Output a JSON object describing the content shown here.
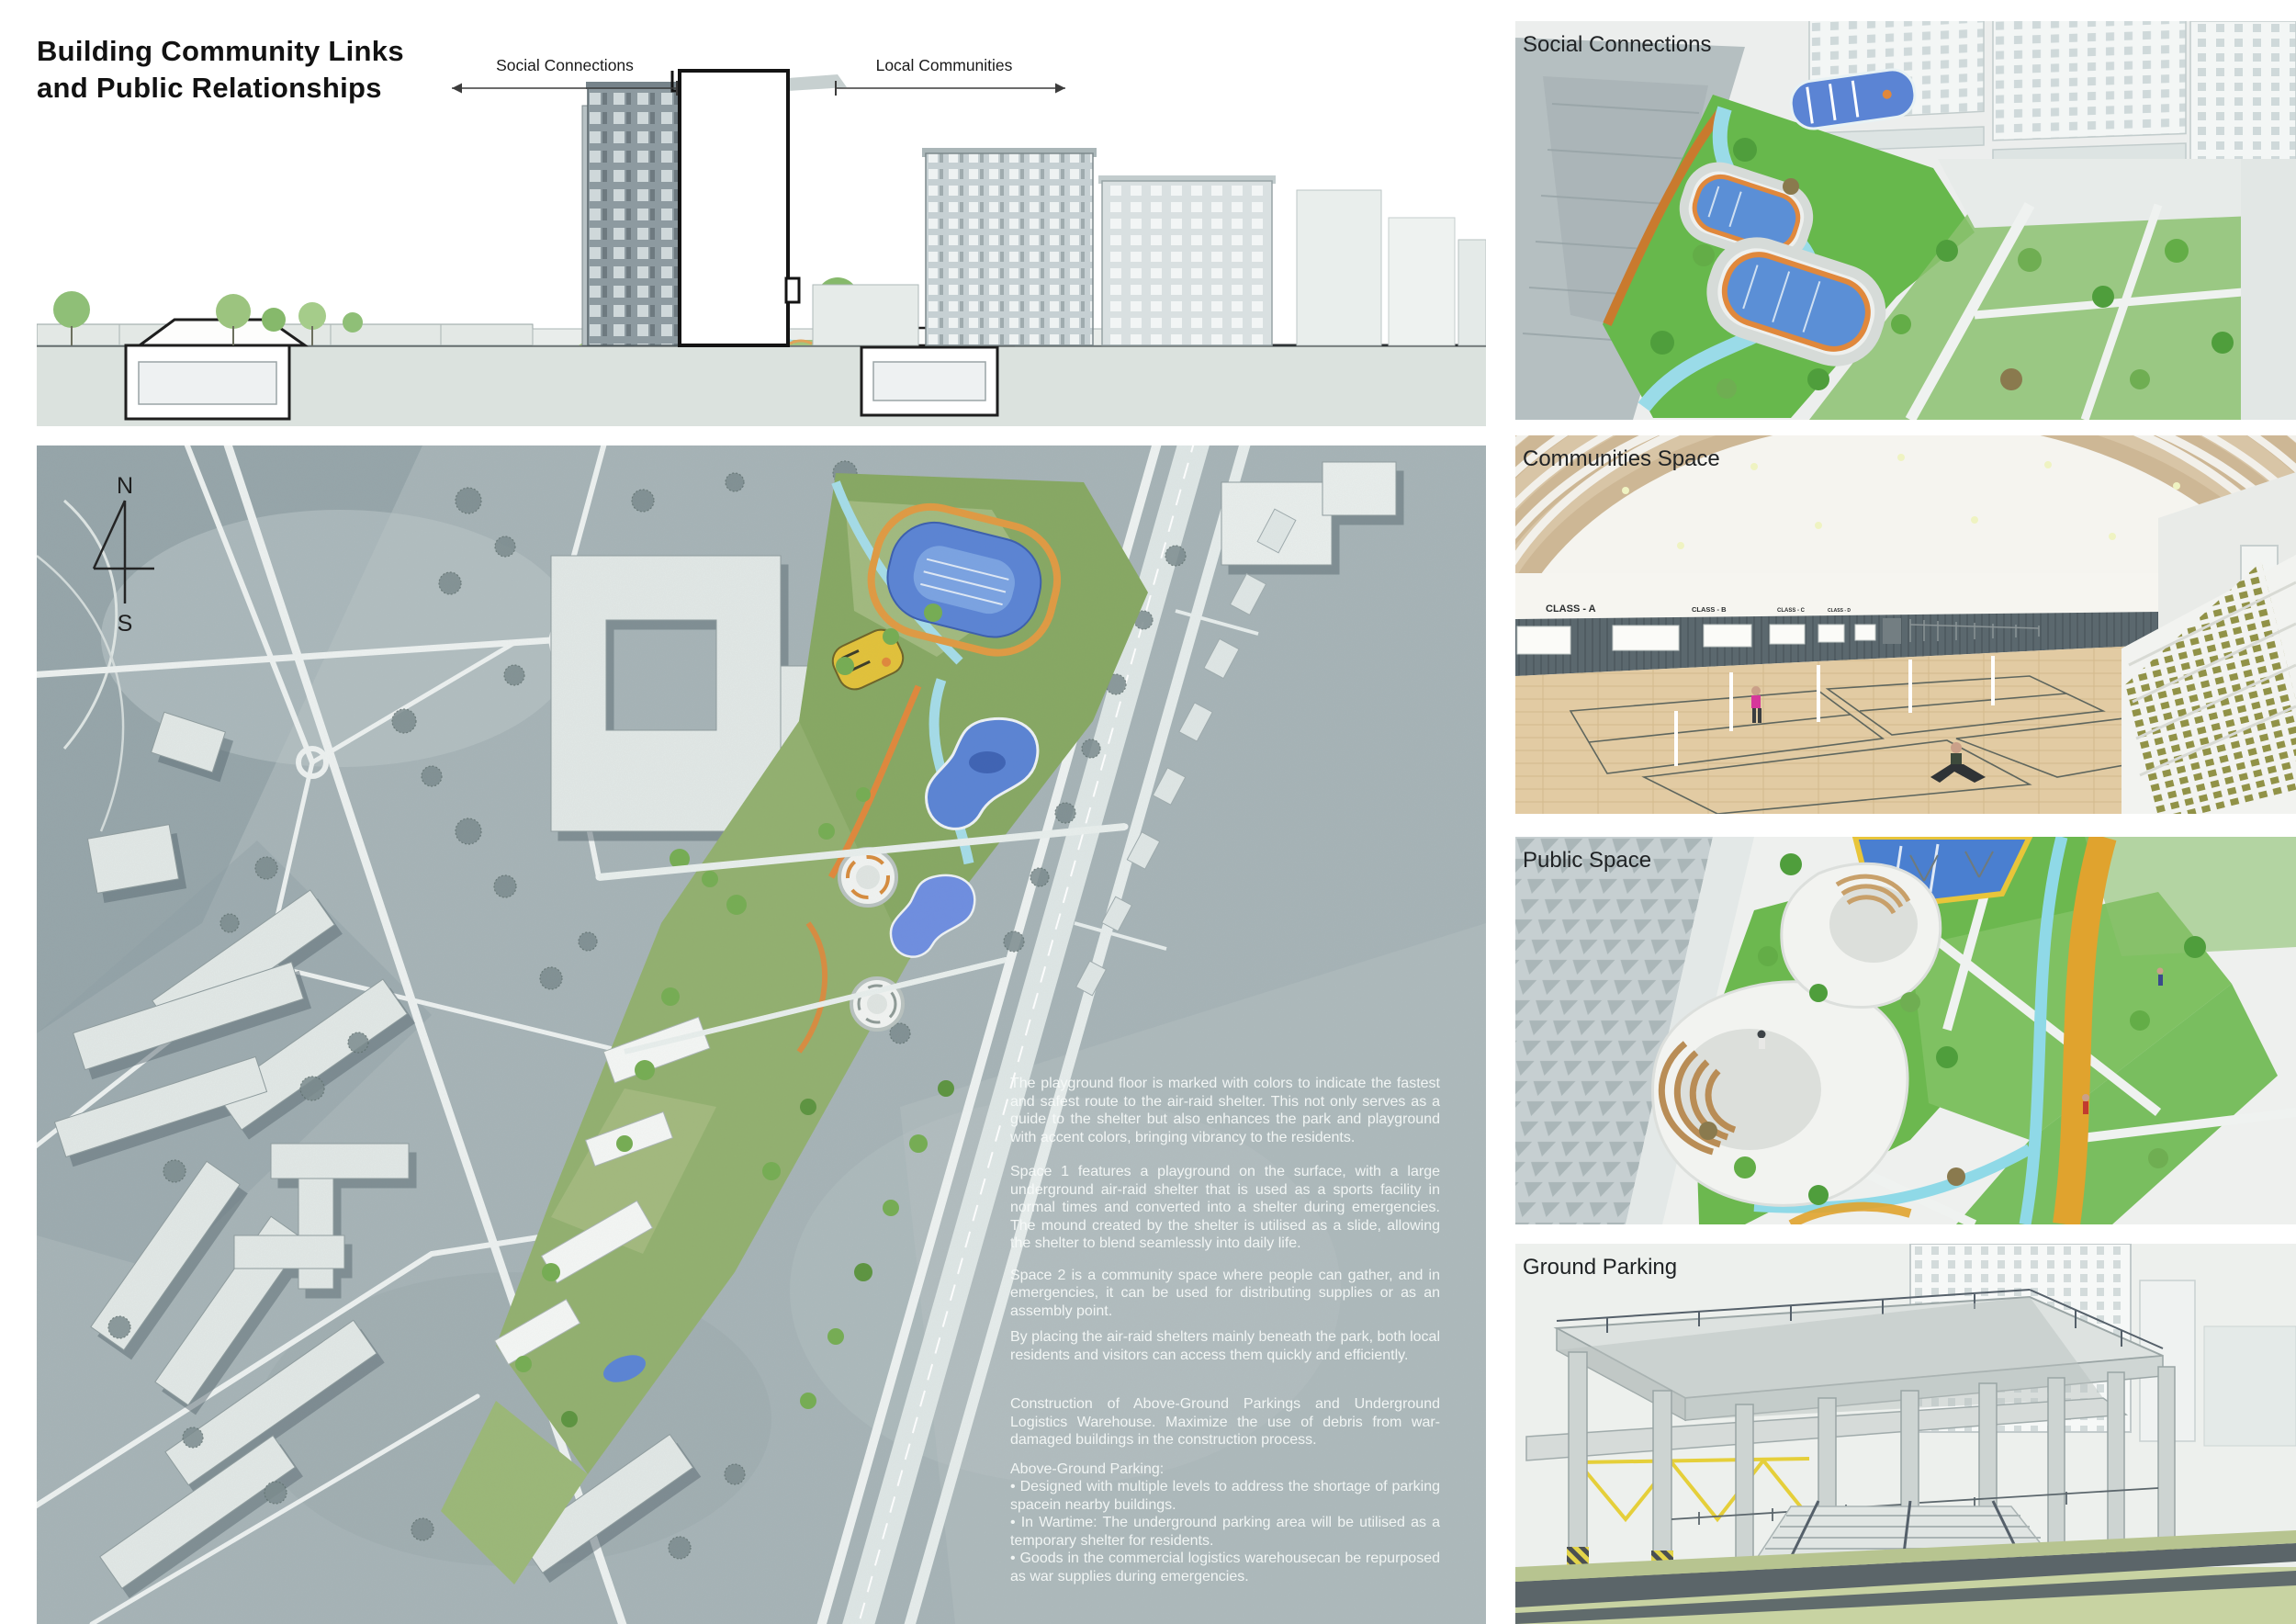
{
  "title": "Building Community Links and Public Relationships",
  "section": {
    "label_left": "Social Connections",
    "label_right": "Local Communities"
  },
  "compass": {
    "north": "N",
    "south": "S"
  },
  "plan_text": {
    "p1": "The playground floor is marked with colors to indicate the fastest and safest route to the air-raid shelter. This not only serves as a guide to the shelter but also enhances the park and playground with accent colors, bringing vibrancy to the residents.",
    "p2": "Space 1 features a playground on the surface, with a large underground air-raid shelter that is used as a sports facility in normal times and converted into a shelter during emergencies. The mound created by the shelter is utilised as a slide, allowing the shelter to blend seamlessly into daily life.",
    "p3": "Space 2 is a community space where people can gather, and in emergencies, it can be used for distributing supplies or as an assembly point.",
    "p4": "By placing the air-raid shelters mainly beneath the park, both local residents and visitors can access them quickly and efficiently.",
    "p5": "Construction of Above-Ground Parkings and Underground Logistics Warehouse. Maximize the use of debris from war-damaged buildings in the construction process.",
    "p6_title": "Above-Ground Parking:",
    "p6_b1": "• Designed with multiple levels to address the shortage of parking spacein nearby buildings.",
    "p6_b2": "• In Wartime: The underground parking area will be utilised as a temporary shelter for residents.",
    "p6_b3": "• Goods in the commercial logistics warehousecan be repurposed as war supplies during emergencies."
  },
  "panels": [
    {
      "label": "Social Connections"
    },
    {
      "label": "Communities Space",
      "class_signs": [
        "CLASS - A",
        "CLASS - B",
        "CLASS - C",
        "CLASS - D"
      ]
    },
    {
      "label": "Public Space"
    },
    {
      "label": "Ground Parking"
    }
  ],
  "colors": {
    "map_base": "#a7b4b7",
    "park_green": "#6cb84f",
    "pool_blue": "#5b84d4",
    "water_cyan": "#9adbe8",
    "accent_orange": "#e0883c",
    "accent_yellow": "#e2c23a",
    "ground_band": "#dbe2de"
  }
}
